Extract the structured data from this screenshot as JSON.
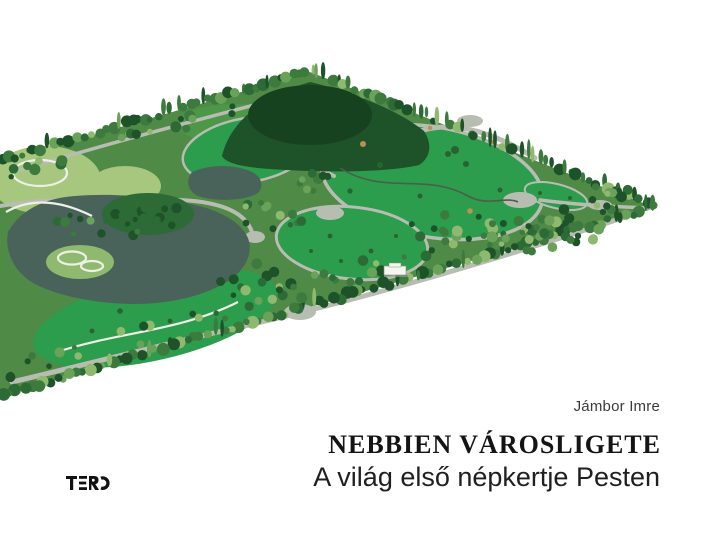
{
  "cover": {
    "author": "Jámbor Imre",
    "title": "NEBBIEN VÁROSLIGETE",
    "subtitle": "A világ első népkertje Pesten",
    "publisher": "TERC"
  },
  "illustration": {
    "name": "varosliget-park-aerial-render",
    "palette": {
      "background": "#ffffff",
      "base": "#4f8a47",
      "meadow": "#2b9d4c",
      "meadow_mid": "#4d9748",
      "meadow_light": "#a6c77d",
      "forest_dark": "#1e5229",
      "forest_deep": "#17421f",
      "forest_mid": "#2d6b36",
      "tree_mid": "#3c7a3e",
      "tree_light": "#69a258",
      "tree_pale": "#8fb96e",
      "water": "#4a635a",
      "path": "#b8bdb2",
      "path_white": "#eef0e8",
      "stream": "#4e5d4a",
      "shrub": "#2a6331",
      "shrub_tan": "#bd8f52",
      "building": "#f6f6f1",
      "logo": "#111111"
    }
  }
}
